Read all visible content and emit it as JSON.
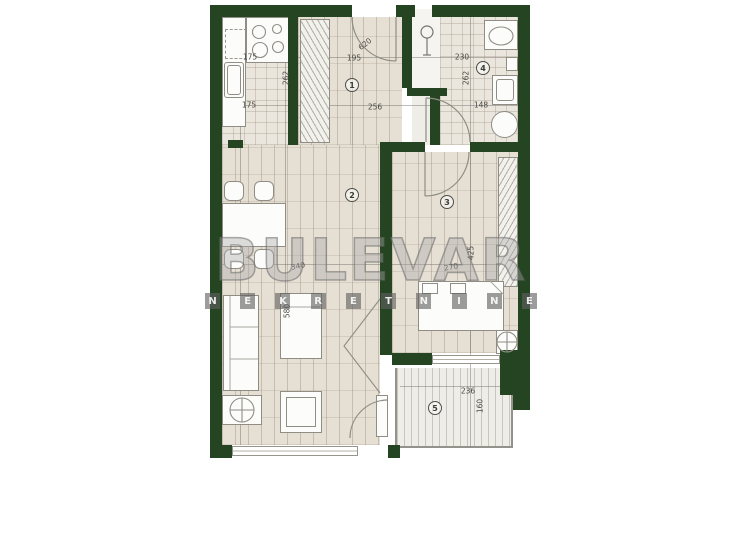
{
  "watermark": {
    "brand": "BULEVAR",
    "letters": [
      "N",
      "E",
      "K",
      "R",
      "E",
      "T",
      "N",
      "I",
      "N",
      "E"
    ]
  },
  "rooms": [
    "1",
    "2",
    "3",
    "4",
    "5"
  ],
  "dims": {
    "kitchen_top": "175",
    "kitchen_side": "262",
    "kitchen_bottom": "175",
    "hall_diag": "620",
    "hall_top": "195",
    "hall_width": "256",
    "bath_top": "230",
    "bath_side": "262",
    "bath_width": "148",
    "living_width": "340",
    "living_side": "580",
    "bedroom_width": "270",
    "bedroom_side": "425",
    "terrace_width": "236",
    "terrace_side": "160"
  },
  "colors": {
    "wall": "#254522",
    "floor": "#e6dfd4",
    "watermark": "#9a9a9a"
  }
}
